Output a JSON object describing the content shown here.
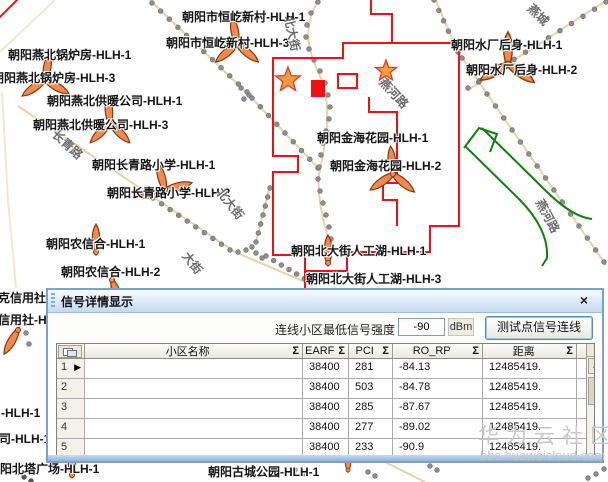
{
  "watermark": {
    "line1": "华为云社区",
    "line2": "bbs.huaweicloud.com"
  },
  "map": {
    "site_labels": [
      {
        "t": "朝阳市恒屹新村-HLH-1",
        "x": 182,
        "y": 8
      },
      {
        "t": "朝阳市恒屹新村-HLH-3",
        "x": 166,
        "y": 34
      },
      {
        "t": "朝阳燕北锅炉房-HLH-1",
        "x": 8,
        "y": 46
      },
      {
        "t": "朝阳燕北锅炉房-HLH-3",
        "x": -8,
        "y": 69
      },
      {
        "t": "朝阳燕北供暖公司-HLH-1",
        "x": 47,
        "y": 92
      },
      {
        "t": "朝阳燕北供暖公司-HLH-3",
        "x": 33,
        "y": 116
      },
      {
        "t": "朝阳长青路小学-HLH-1",
        "x": 92,
        "y": 156
      },
      {
        "t": "朝阳长青路小学-HLH-2",
        "x": 107,
        "y": 184
      },
      {
        "t": "朝阳农信合-HLH-1",
        "x": 46,
        "y": 235
      },
      {
        "t": "朝阳农信合-HLH-2",
        "x": 61,
        "y": 263
      },
      {
        "t": "朝阳水厂后身-HLH-1",
        "x": 451,
        "y": 36
      },
      {
        "t": "朝阳水厂后身-HLH-2",
        "x": 466,
        "y": 61
      },
      {
        "t": "朝阳金海花园-HLH-1",
        "x": 317,
        "y": 129
      },
      {
        "t": "朝阳金海花园-HLH-2",
        "x": 330,
        "y": 157
      },
      {
        "t": "朝阳北大街人工湖-HLH-1",
        "x": 291,
        "y": 242
      },
      {
        "t": "朝阳北大街人工湖-HLH-3",
        "x": 306,
        "y": 270
      },
      {
        "t": "克信用社-HLH-1",
        "x": -2,
        "y": 289
      },
      {
        "t": "克信用社-HLH-2",
        "x": -14,
        "y": 311
      },
      {
        "t": "-HLH-1",
        "x": 1,
        "y": 406
      },
      {
        "t": "司-HLH-1",
        "x": -1,
        "y": 430
      },
      {
        "t": "朝阳北塔广场-HLH-1",
        "x": -12,
        "y": 460
      },
      {
        "t": "朝阳古城公园-HLH-1",
        "x": 208,
        "y": 463
      }
    ],
    "road_labels": [
      {
        "t": "长青路",
        "x": 60,
        "y": 126,
        "r": 42
      },
      {
        "t": "北大街",
        "x": 297,
        "y": 14,
        "r": 78
      },
      {
        "t": "北大街",
        "x": 226,
        "y": 184,
        "r": 52
      },
      {
        "t": "大街",
        "x": 192,
        "y": 248,
        "r": 52
      },
      {
        "t": "燕河路",
        "x": 388,
        "y": 74,
        "r": 47
      },
      {
        "t": "燕河路",
        "x": 547,
        "y": 196,
        "r": 62
      },
      {
        "t": "燕城",
        "x": 536,
        "y": 0,
        "r": 45
      },
      {
        "t": "胡同",
        "x": -2,
        "y": 98,
        "r": 84
      }
    ],
    "markers": {
      "antenna_sites": [
        {
          "x": 237,
          "y": 44,
          "rot": [
            350,
            130,
            230
          ]
        },
        {
          "x": 45,
          "y": 80,
          "rot": [
            10,
            120,
            235
          ]
        },
        {
          "x": 110,
          "y": 123,
          "rot": [
            355,
            135,
            225
          ]
        },
        {
          "x": 165,
          "y": 190,
          "rot": [
            345,
            75,
            255
          ]
        },
        {
          "x": 96,
          "y": 252,
          "rot": [
            0
          ]
        },
        {
          "x": 112,
          "y": 280,
          "rot": [
            160
          ]
        },
        {
          "x": 393,
          "y": 174,
          "rot": [
            355,
            130,
            235
          ]
        },
        {
          "x": 508,
          "y": 64,
          "rot": [
            0,
            125,
            240
          ],
          "scale": 1.15
        },
        {
          "x": 328,
          "y": 263,
          "rot": [
            0
          ]
        },
        {
          "x": 72,
          "y": 475,
          "rot": [
            0
          ]
        },
        {
          "x": 348,
          "y": 470,
          "rot": [
            0
          ],
          "scale": 0.8
        },
        {
          "x": 18,
          "y": 330,
          "rot": [
            210
          ]
        }
      ],
      "stars": [
        {
          "x": 288,
          "y": 80,
          "r": 13
        },
        {
          "x": 386,
          "y": 71,
          "r": 11
        }
      ],
      "colors": {
        "antenna": "#F18A4D",
        "antenna_stroke": "#8C3508",
        "star": "#F59B40",
        "star_stroke": "#E23B23",
        "boundary_red": "#F01010",
        "route_green": "#118011"
      }
    }
  },
  "dialog": {
    "title": "信号详情显示",
    "close_label": "×",
    "toolbar": {
      "label": "连线小区最低信号强度",
      "value": "-90",
      "unit": "dBm",
      "button": "测试点信号连线"
    },
    "table": {
      "sigma": "Σ",
      "columns": [
        "小区名称",
        "EARF",
        "PCI",
        "RO_RP",
        "距离"
      ],
      "rows": [
        {
          "num": "1",
          "name": "",
          "earf": "38400",
          "pci": "281",
          "ro_rp": "-84.13",
          "dist": "12485419."
        },
        {
          "num": "2",
          "name": "",
          "earf": "38400",
          "pci": "503",
          "ro_rp": "-84.78",
          "dist": "12485419."
        },
        {
          "num": "3",
          "name": "",
          "earf": "38400",
          "pci": "285",
          "ro_rp": "-87.67",
          "dist": "12485419."
        },
        {
          "num": "4",
          "name": "",
          "earf": "38400",
          "pci": "277",
          "ro_rp": "-89.02",
          "dist": "12485419."
        },
        {
          "num": "5",
          "name": "",
          "earf": "38400",
          "pci": "233",
          "ro_rp": "-90.9",
          "dist": "12485419."
        },
        {
          "num": "6",
          "name": "朝阳兴隆当铺-HLH-2",
          "earf": "38400",
          "pci": "289",
          "ro_rp": "-93.75",
          "dist": "5868.9498"
        }
      ]
    }
  }
}
